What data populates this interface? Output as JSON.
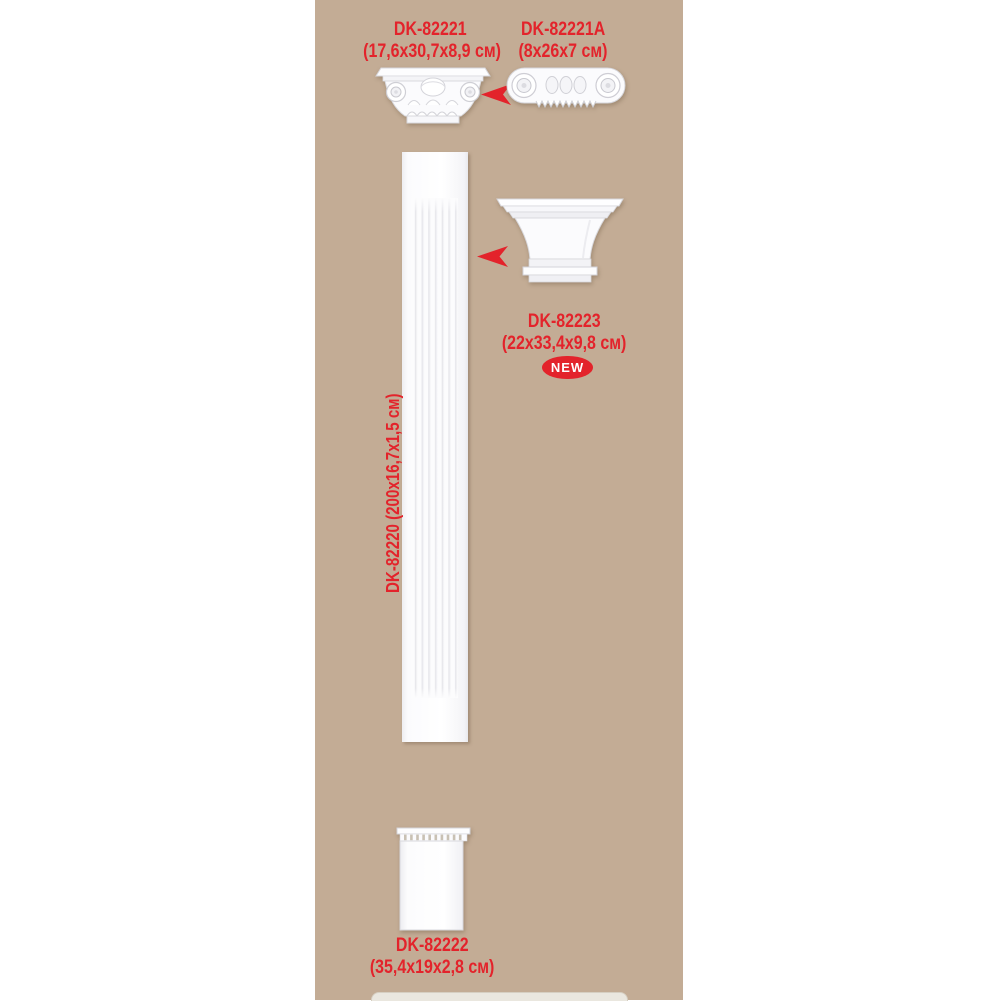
{
  "colors": {
    "page_background": "#ffffff",
    "panel_background": "#c3ac95",
    "accent_red": "#e3232b",
    "product_white": "#fdfdfe"
  },
  "products": {
    "corinthian_capital": {
      "code": "DK-82221",
      "dims": "(17,6x30,7x8,9 см)"
    },
    "ionic_capital": {
      "code": "DK-82221A",
      "dims": "(8x26x7 см)"
    },
    "plain_capital": {
      "code": "DK-82223",
      "dims": "(22x33,4x9,8 см)",
      "badge": "NEW"
    },
    "pilaster_shaft": {
      "label": "DK-82220 (200x16,7x1,5 см)"
    },
    "pilaster_base": {
      "code": "DK-82222",
      "dims": "(35,4x19x2,8 см)"
    }
  }
}
